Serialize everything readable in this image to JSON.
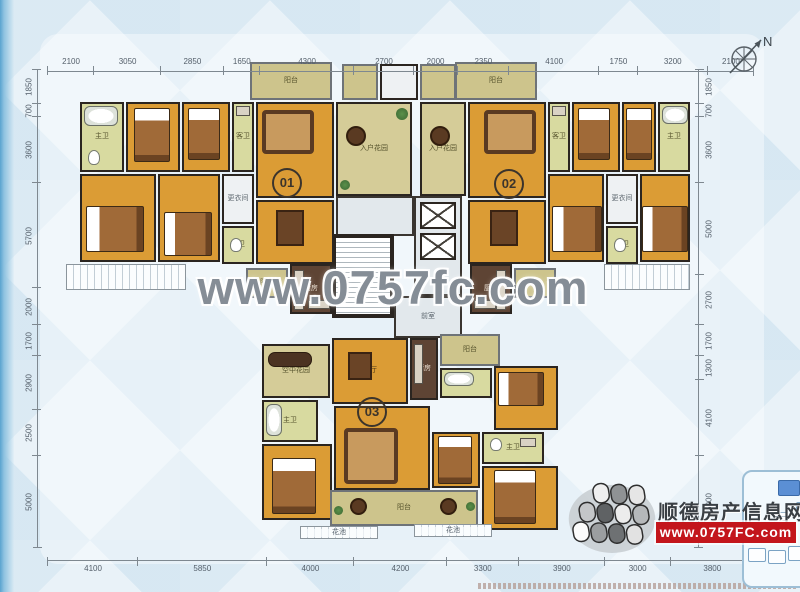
{
  "watermark": "www.0757fc.com",
  "compass": {
    "label": "N"
  },
  "logo": {
    "site_name": "顺德房产信息网",
    "url": "www.0757FC.com"
  },
  "dimensions": {
    "top": [
      2100,
      3050,
      2850,
      1650,
      4300,
      2700,
      2000,
      2350,
      4100,
      1750,
      3200,
      2100
    ],
    "bottom": [
      4100,
      5850,
      4000,
      4200,
      3300,
      3900,
      3000,
      3800
    ],
    "left": [
      1850,
      700,
      3600,
      5700,
      2000,
      1700,
      2900,
      2500,
      5000
    ],
    "right": [
      1850,
      700,
      3600,
      5000,
      2700,
      1700,
      1300,
      4100,
      5000
    ]
  },
  "badges": [
    {
      "label": "01",
      "x": 285,
      "y": 181
    },
    {
      "label": "02",
      "x": 507,
      "y": 182
    },
    {
      "label": "03",
      "x": 370,
      "y": 410
    }
  ],
  "rooms": [
    {
      "n": "balcony-top-01",
      "l": "阳台",
      "x": 250,
      "y": 62,
      "w": 82,
      "h": 38,
      "k": "balcony"
    },
    {
      "n": "master-bath-01a",
      "l": "主卫",
      "x": 80,
      "y": 102,
      "w": 44,
      "h": 70,
      "k": "bath"
    },
    {
      "n": "bedroom-01a",
      "l": "卧室",
      "x": 126,
      "y": 102,
      "w": 54,
      "h": 70,
      "k": "orange"
    },
    {
      "n": "bedroom-01b",
      "l": "卧室",
      "x": 182,
      "y": 102,
      "w": 48,
      "h": 70,
      "k": "orange"
    },
    {
      "n": "guest-bath-01",
      "l": "客卫",
      "x": 232,
      "y": 102,
      "w": 22,
      "h": 70,
      "k": "bath"
    },
    {
      "n": "living-01",
      "l": "客厅",
      "x": 256,
      "y": 102,
      "w": 78,
      "h": 96,
      "k": "orange"
    },
    {
      "n": "entry-garden-01",
      "l": "入户花园",
      "x": 336,
      "y": 102,
      "w": 76,
      "h": 94,
      "k": "garden"
    },
    {
      "n": "dining-01",
      "l": "餐厅",
      "x": 256,
      "y": 200,
      "w": 78,
      "h": 64,
      "k": "orange"
    },
    {
      "n": "master-bed-01",
      "l": "主卧",
      "x": 80,
      "y": 174,
      "w": 76,
      "h": 88,
      "k": "orange"
    },
    {
      "n": "bedroom-01c",
      "l": "卧室",
      "x": 158,
      "y": 174,
      "w": 62,
      "h": 88,
      "k": "orange"
    },
    {
      "n": "dressing-01",
      "l": "更衣间",
      "x": 222,
      "y": 174,
      "w": 32,
      "h": 50,
      "k": "light"
    },
    {
      "n": "master-bath-01b",
      "l": "主卫",
      "x": 222,
      "y": 226,
      "w": 32,
      "h": 38,
      "k": "bath"
    },
    {
      "n": "balcony-01b",
      "l": "阳台",
      "x": 246,
      "y": 268,
      "w": 42,
      "h": 30,
      "k": "balcony"
    },
    {
      "n": "kitchen-01",
      "l": "厨房",
      "x": 290,
      "y": 264,
      "w": 42,
      "h": 50,
      "k": "kitchen"
    },
    {
      "n": "rail-01",
      "l": "",
      "x": 66,
      "y": 264,
      "w": 120,
      "h": 26,
      "k": "rail"
    },
    {
      "n": "utility-top-a",
      "l": "",
      "x": 342,
      "y": 64,
      "w": 36,
      "h": 36,
      "k": "balcony"
    },
    {
      "n": "utility-top-b",
      "l": "",
      "x": 380,
      "y": 64,
      "w": 38,
      "h": 36,
      "k": "light"
    },
    {
      "n": "utility-top-c",
      "l": "",
      "x": 420,
      "y": 64,
      "w": 36,
      "h": 36,
      "k": "balcony"
    },
    {
      "n": "balcony-top-02",
      "l": "阳台",
      "x": 455,
      "y": 62,
      "w": 82,
      "h": 38,
      "k": "balcony"
    },
    {
      "n": "entry-garden-02",
      "l": "入户花园",
      "x": 420,
      "y": 102,
      "w": 46,
      "h": 94,
      "k": "garden"
    },
    {
      "n": "living-02",
      "l": "客厅",
      "x": 468,
      "y": 102,
      "w": 78,
      "h": 96,
      "k": "orange"
    },
    {
      "n": "dining-02",
      "l": "餐厅",
      "x": 468,
      "y": 200,
      "w": 78,
      "h": 64,
      "k": "orange"
    },
    {
      "n": "guest-bath-02",
      "l": "客卫",
      "x": 548,
      "y": 102,
      "w": 22,
      "h": 70,
      "k": "bath"
    },
    {
      "n": "bedroom-02a",
      "l": "卧室",
      "x": 572,
      "y": 102,
      "w": 48,
      "h": 70,
      "k": "orange"
    },
    {
      "n": "bedroom-02b",
      "l": "卧室",
      "x": 622,
      "y": 102,
      "w": 34,
      "h": 70,
      "k": "orange"
    },
    {
      "n": "master-bath-02a",
      "l": "主卫",
      "x": 658,
      "y": 102,
      "w": 32,
      "h": 70,
      "k": "bath"
    },
    {
      "n": "bedroom-02c",
      "l": "卧室",
      "x": 548,
      "y": 174,
      "w": 56,
      "h": 88,
      "k": "orange"
    },
    {
      "n": "dressing-02",
      "l": "更衣间",
      "x": 606,
      "y": 174,
      "w": 32,
      "h": 50,
      "k": "light"
    },
    {
      "n": "master-bath-02b",
      "l": "主卫",
      "x": 606,
      "y": 226,
      "w": 32,
      "h": 38,
      "k": "bath"
    },
    {
      "n": "master-bed-02",
      "l": "主卧",
      "x": 640,
      "y": 174,
      "w": 50,
      "h": 88,
      "k": "orange"
    },
    {
      "n": "balcony-02b",
      "l": "阳台",
      "x": 514,
      "y": 268,
      "w": 42,
      "h": 30,
      "k": "balcony"
    },
    {
      "n": "kitchen-02",
      "l": "厨房",
      "x": 470,
      "y": 264,
      "w": 42,
      "h": 50,
      "k": "kitchen"
    },
    {
      "n": "rail-02",
      "l": "",
      "x": 604,
      "y": 264,
      "w": 86,
      "h": 26,
      "k": "rail"
    },
    {
      "n": "hall-top",
      "l": "",
      "x": 336,
      "y": 196,
      "w": 78,
      "h": 40,
      "k": "hall"
    },
    {
      "n": "stairwell",
      "l": "",
      "x": 332,
      "y": 234,
      "w": 62,
      "h": 84,
      "k": "light"
    },
    {
      "n": "elevator-hall",
      "l": "",
      "x": 414,
      "y": 196,
      "w": 48,
      "h": 100,
      "k": "hall"
    },
    {
      "n": "lobby",
      "l": "前室",
      "x": 394,
      "y": 296,
      "w": 68,
      "h": 42,
      "k": "hall"
    },
    {
      "n": "sky-garden-03",
      "l": "空中花园",
      "x": 262,
      "y": 344,
      "w": 68,
      "h": 54,
      "k": "garden"
    },
    {
      "n": "dining-03",
      "l": "餐厅",
      "x": 332,
      "y": 338,
      "w": 76,
      "h": 66,
      "k": "orange"
    },
    {
      "n": "kitchen-03",
      "l": "厨房",
      "x": 410,
      "y": 338,
      "w": 28,
      "h": 62,
      "k": "kitchen"
    },
    {
      "n": "balcony-03a",
      "l": "阳台",
      "x": 440,
      "y": 334,
      "w": 60,
      "h": 32,
      "k": "balcony"
    },
    {
      "n": "guest-bath-03",
      "l": "客卫",
      "x": 440,
      "y": 368,
      "w": 52,
      "h": 30,
      "k": "bath"
    },
    {
      "n": "bedroom-03a",
      "l": "卧室",
      "x": 494,
      "y": 366,
      "w": 64,
      "h": 64,
      "k": "orange"
    },
    {
      "n": "master-bath-03a",
      "l": "主卫",
      "x": 262,
      "y": 400,
      "w": 56,
      "h": 42,
      "k": "bath"
    },
    {
      "n": "master-bed-03",
      "l": "主卧",
      "x": 262,
      "y": 444,
      "w": 70,
      "h": 76,
      "k": "orange"
    },
    {
      "n": "living-03",
      "l": "客厅",
      "x": 334,
      "y": 406,
      "w": 96,
      "h": 84,
      "k": "orange"
    },
    {
      "n": "bedroom-03b",
      "l": "卧室",
      "x": 432,
      "y": 432,
      "w": 48,
      "h": 56,
      "k": "orange"
    },
    {
      "n": "master-bath-03b",
      "l": "主卫",
      "x": 482,
      "y": 432,
      "w": 62,
      "h": 32,
      "k": "bath"
    },
    {
      "n": "bedroom-03c",
      "l": "卧室",
      "x": 482,
      "y": 466,
      "w": 76,
      "h": 64,
      "k": "orange"
    },
    {
      "n": "balcony-03b",
      "l": "阳台",
      "x": 330,
      "y": 490,
      "w": 148,
      "h": 36,
      "k": "balcony"
    },
    {
      "n": "planter-03a",
      "l": "花池",
      "x": 300,
      "y": 526,
      "w": 78,
      "h": 13,
      "k": "rail"
    },
    {
      "n": "planter-03b",
      "l": "花池",
      "x": 414,
      "y": 524,
      "w": 78,
      "h": 13,
      "k": "rail"
    }
  ],
  "furniture": [
    {
      "t": "tub",
      "x": 84,
      "y": 106,
      "w": 34,
      "h": 20
    },
    {
      "t": "wc",
      "x": 88,
      "y": 150,
      "w": 12,
      "h": 15
    },
    {
      "t": "bed",
      "x": 134,
      "y": 108,
      "w": 36,
      "h": 54
    },
    {
      "t": "bed",
      "x": 188,
      "y": 108,
      "w": 32,
      "h": 52
    },
    {
      "t": "counter",
      "x": 236,
      "y": 106,
      "w": 14,
      "h": 10
    },
    {
      "t": "sofa",
      "x": 262,
      "y": 110,
      "w": 52,
      "h": 44
    },
    {
      "t": "tblr",
      "x": 346,
      "y": 126,
      "w": 20,
      "h": 20
    },
    {
      "t": "plant",
      "x": 396,
      "y": 108,
      "w": 12,
      "h": 12
    },
    {
      "t": "plant",
      "x": 340,
      "y": 180,
      "w": 10,
      "h": 10
    },
    {
      "t": "tbl",
      "x": 276,
      "y": 210,
      "w": 28,
      "h": 36
    },
    {
      "t": "bedh",
      "x": 86,
      "y": 206,
      "w": 58,
      "h": 46
    },
    {
      "t": "bedh",
      "x": 164,
      "y": 212,
      "w": 48,
      "h": 44
    },
    {
      "t": "wc",
      "x": 230,
      "y": 238,
      "w": 12,
      "h": 14
    },
    {
      "t": "counter",
      "x": 294,
      "y": 270,
      "w": 10,
      "h": 40
    },
    {
      "t": "counter",
      "x": 308,
      "y": 300,
      "w": 22,
      "h": 9
    },
    {
      "t": "stairs",
      "x": 334,
      "y": 236,
      "w": 58,
      "h": 80
    },
    {
      "t": "elev",
      "x": 420,
      "y": 202,
      "w": 36,
      "h": 27
    },
    {
      "t": "elev",
      "x": 420,
      "y": 233,
      "w": 36,
      "h": 27
    },
    {
      "t": "sofa",
      "x": 484,
      "y": 110,
      "w": 52,
      "h": 44
    },
    {
      "t": "tblr",
      "x": 430,
      "y": 126,
      "w": 20,
      "h": 20
    },
    {
      "t": "tbl",
      "x": 490,
      "y": 210,
      "w": 28,
      "h": 36
    },
    {
      "t": "counter",
      "x": 552,
      "y": 106,
      "w": 14,
      "h": 10
    },
    {
      "t": "bed",
      "x": 578,
      "y": 108,
      "w": 32,
      "h": 52
    },
    {
      "t": "bed",
      "x": 626,
      "y": 108,
      "w": 26,
      "h": 52
    },
    {
      "t": "tub",
      "x": 662,
      "y": 106,
      "w": 26,
      "h": 18
    },
    {
      "t": "bedh",
      "x": 552,
      "y": 206,
      "w": 50,
      "h": 46
    },
    {
      "t": "bedh",
      "x": 642,
      "y": 206,
      "w": 46,
      "h": 46
    },
    {
      "t": "wc",
      "x": 614,
      "y": 238,
      "w": 12,
      "h": 14
    },
    {
      "t": "counter",
      "x": 496,
      "y": 270,
      "w": 10,
      "h": 40
    },
    {
      "t": "counter",
      "x": 474,
      "y": 300,
      "w": 22,
      "h": 9
    },
    {
      "t": "chaise",
      "x": 268,
      "y": 352,
      "w": 44,
      "h": 15
    },
    {
      "t": "tbl",
      "x": 348,
      "y": 352,
      "w": 24,
      "h": 28
    },
    {
      "t": "counter",
      "x": 414,
      "y": 344,
      "w": 9,
      "h": 40
    },
    {
      "t": "tub",
      "x": 444,
      "y": 372,
      "w": 30,
      "h": 14
    },
    {
      "t": "bedh",
      "x": 498,
      "y": 372,
      "w": 46,
      "h": 34
    },
    {
      "t": "tub",
      "x": 266,
      "y": 404,
      "w": 16,
      "h": 32
    },
    {
      "t": "bed",
      "x": 272,
      "y": 458,
      "w": 44,
      "h": 56
    },
    {
      "t": "sofa",
      "x": 344,
      "y": 428,
      "w": 54,
      "h": 56
    },
    {
      "t": "bed",
      "x": 438,
      "y": 436,
      "w": 34,
      "h": 48
    },
    {
      "t": "wc",
      "x": 490,
      "y": 438,
      "w": 12,
      "h": 13
    },
    {
      "t": "counter",
      "x": 520,
      "y": 438,
      "w": 16,
      "h": 9
    },
    {
      "t": "bed",
      "x": 494,
      "y": 470,
      "w": 42,
      "h": 54
    },
    {
      "t": "tblr",
      "x": 350,
      "y": 498,
      "w": 17,
      "h": 17
    },
    {
      "t": "tblr",
      "x": 440,
      "y": 498,
      "w": 17,
      "h": 17
    },
    {
      "t": "plant",
      "x": 334,
      "y": 506,
      "w": 9,
      "h": 9
    },
    {
      "t": "plant",
      "x": 466,
      "y": 502,
      "w": 9,
      "h": 9
    }
  ]
}
